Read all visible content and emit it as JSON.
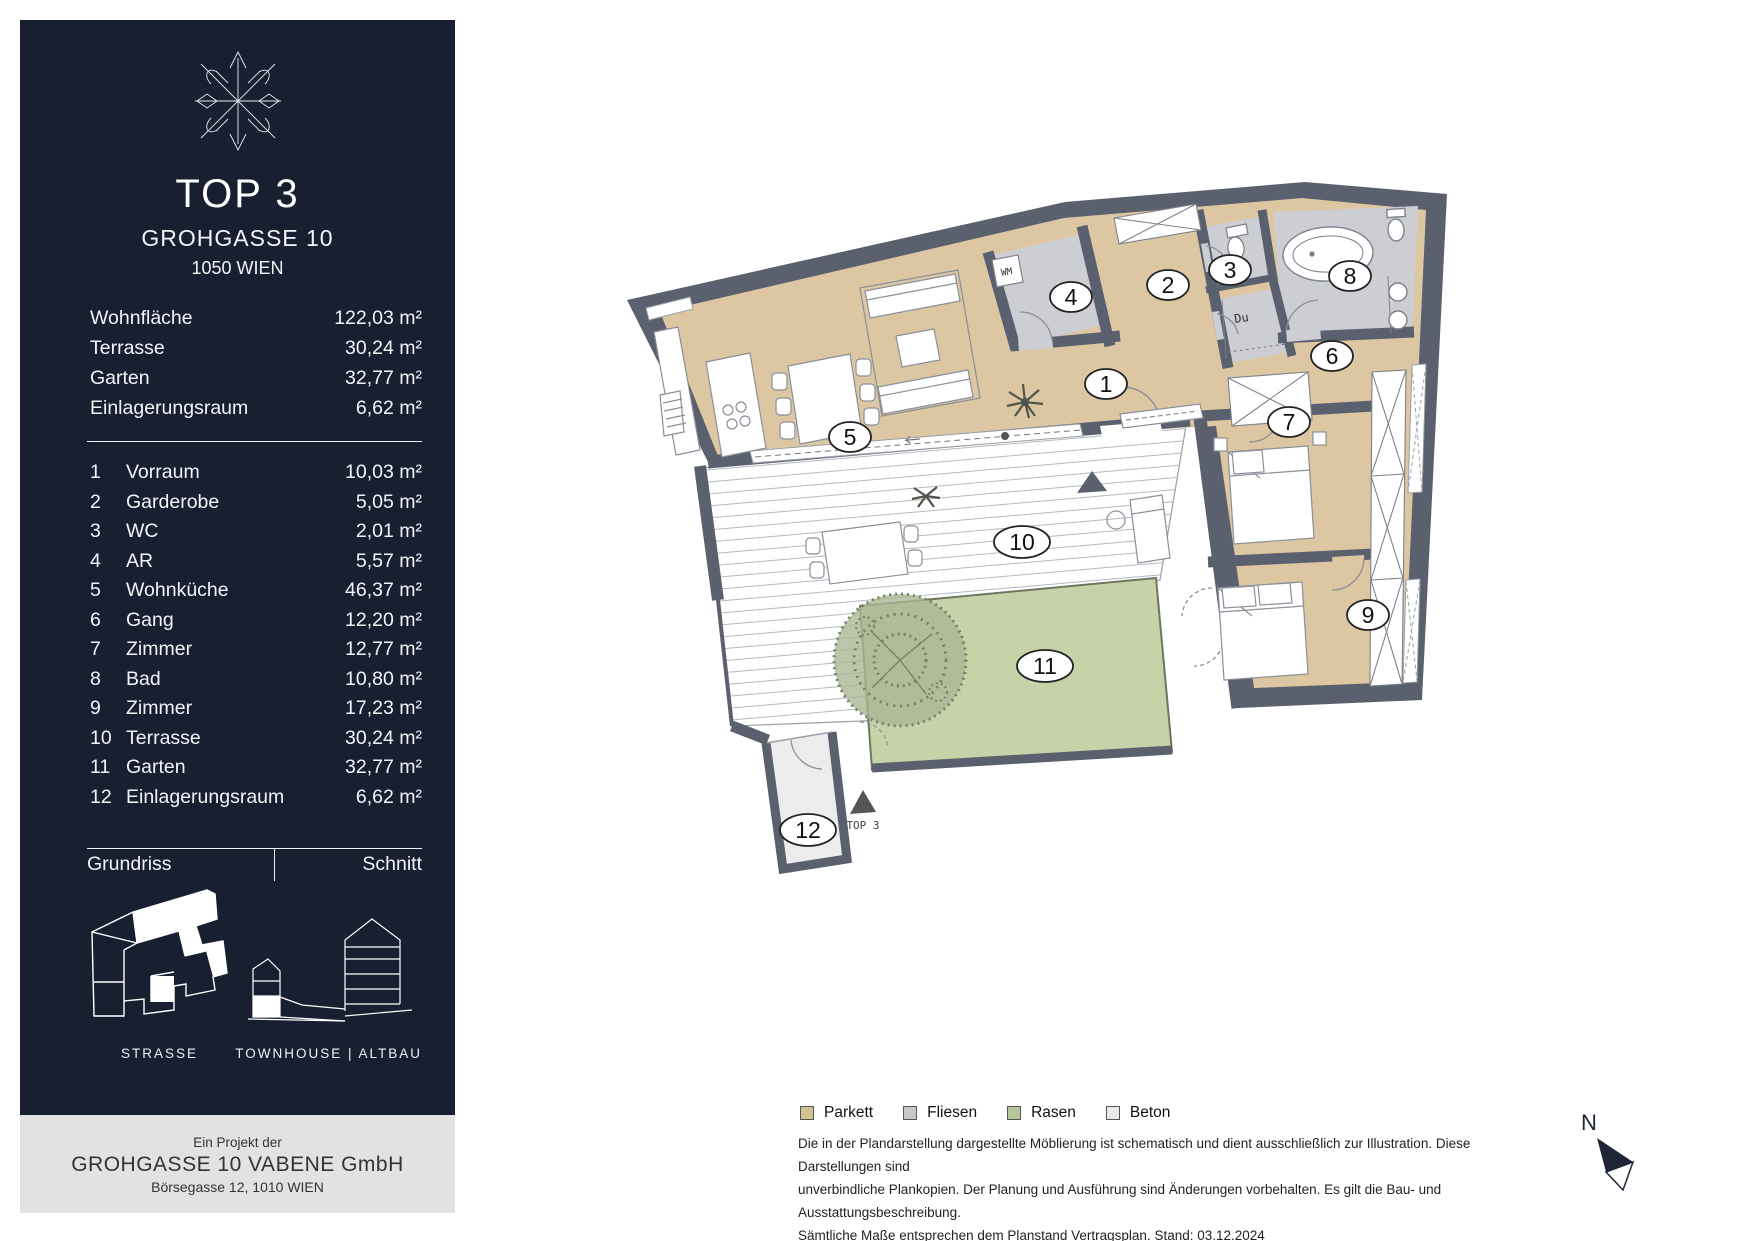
{
  "sidebar": {
    "unit_title": "TOP 3",
    "address_line1": "GROHGASSE 10",
    "address_line2": "1050 WIEN",
    "summary": [
      {
        "label": "Wohnfläche",
        "area": "122,03 m²"
      },
      {
        "label": "Terrasse",
        "area": "30,24 m²"
      },
      {
        "label": "Garten",
        "area": "32,77 m²"
      },
      {
        "label": "Einlagerungsraum",
        "area": "6,62 m²"
      }
    ],
    "rooms": [
      {
        "no": "1",
        "label": "Vorraum",
        "area": "10,03 m²"
      },
      {
        "no": "2",
        "label": "Garderobe",
        "area": "5,05 m²"
      },
      {
        "no": "3",
        "label": "WC",
        "area": "2,01 m²"
      },
      {
        "no": "4",
        "label": "AR",
        "area": "5,57 m²"
      },
      {
        "no": "5",
        "label": "Wohnküche",
        "area": "46,37 m²"
      },
      {
        "no": "6",
        "label": "Gang",
        "area": "12,20 m²"
      },
      {
        "no": "7",
        "label": "Zimmer",
        "area": "12,77 m²"
      },
      {
        "no": "8",
        "label": "Bad",
        "area": "10,80 m²"
      },
      {
        "no": "9",
        "label": "Zimmer",
        "area": "17,23 m²"
      },
      {
        "no": "10",
        "label": "Terrasse",
        "area": "30,24 m²"
      },
      {
        "no": "11",
        "label": "Garten",
        "area": "32,77 m²"
      },
      {
        "no": "12",
        "label": "Einlagerungsraum",
        "area": "6,62 m²"
      }
    ],
    "plan_toggle": {
      "left": "Grundriss",
      "right": "Schnitt"
    },
    "captions": {
      "grundriss": "STRASSE",
      "schnitt": "TOWNHOUSE  |  ALTBAU"
    },
    "footer": {
      "line1": "Ein Projekt der",
      "line2": "GROHGASSE 10 VABENE GmbH",
      "line3": "Börsegasse 12, 1010 WIEN"
    }
  },
  "plan": {
    "labels": [
      {
        "n": "1"
      },
      {
        "n": "2"
      },
      {
        "n": "3"
      },
      {
        "n": "4"
      },
      {
        "n": "5"
      },
      {
        "n": "6"
      },
      {
        "n": "7"
      },
      {
        "n": "8"
      },
      {
        "n": "9"
      },
      {
        "n": "10"
      },
      {
        "n": "11"
      },
      {
        "n": "12"
      }
    ],
    "annotations": {
      "wm": "WM",
      "du": "Du",
      "entrance": "TOP 3",
      "north": "N"
    }
  },
  "legend": {
    "items": [
      {
        "label": "Parkett",
        "color": "#d5c294"
      },
      {
        "label": "Fliesen",
        "color": "#c7c8cb"
      },
      {
        "label": "Rasen",
        "color": "#b5c79a"
      },
      {
        "label": "Beton",
        "color": "#ebebeb"
      }
    ]
  },
  "disclaimer": {
    "line1": "Die in der Plandarstellung dargestellte Möblierung ist schematisch und dient ausschließlich zur Illustration. Diese Darstellungen sind",
    "line2": "unverbindliche Plankopien. Der Planung und Ausführung sind Änderungen vorbehalten. Es gilt die Bau- und Ausstattungsbeschreibung.",
    "line3": "Sämtliche Maße entsprechen dem Planstand Vertragsplan. Stand: 03.12.2024"
  },
  "colors": {
    "sidebar": "#181f31",
    "wall": "#5b606e",
    "parkett": "#dcc7a2",
    "fliesen": "#cdced3",
    "rasen": "#c6d3a8",
    "beton": "#ececec"
  }
}
